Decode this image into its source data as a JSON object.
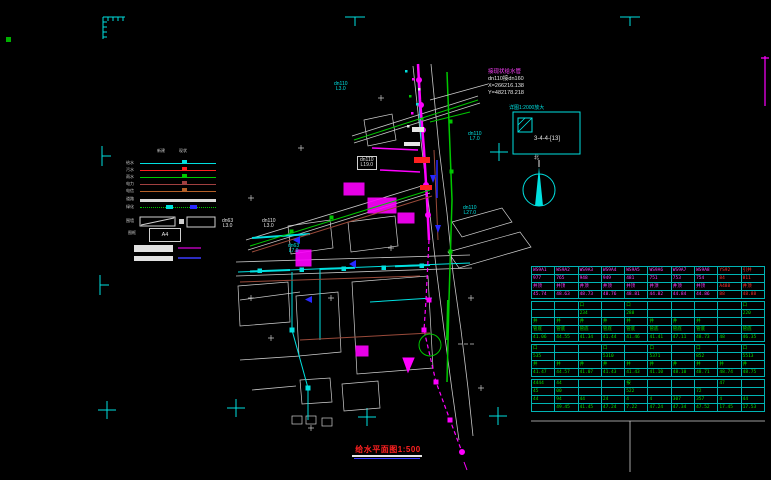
{
  "colors": {
    "cyan": "#00e0e0",
    "magenta": "#ff00ff",
    "green": "#00c800",
    "white": "#d8d8d8",
    "red": "#ff3030",
    "blue": "#2828ff",
    "brown": "#9a4a3a"
  },
  "annotation": {
    "line1": "接现状给水管",
    "line2": "dn110接dn160",
    "line3": "X=266216.138",
    "line4": "Y=482178.218"
  },
  "detail": {
    "caption": "详图1:2000放大",
    "ref": "3-4-4-[13]"
  },
  "north": {
    "label": "北"
  },
  "title": {
    "text": "给水平面图1:500"
  },
  "legend": {
    "col_headers": [
      "新建",
      "现状"
    ],
    "rows": [
      {
        "label": "给水",
        "color": "#00e0e0",
        "style": "solid"
      },
      {
        "label": "污水",
        "color": "#ff2020",
        "style": "solid"
      },
      {
        "label": "雨水",
        "color": "#00c800",
        "style": "solid"
      },
      {
        "label": "电力",
        "color": "#a04040",
        "style": "solid"
      },
      {
        "label": "电信",
        "color": "#b46028",
        "style": "solid"
      },
      {
        "label": "道路",
        "color": "#d8d8d8",
        "style": "thick"
      },
      {
        "label": "绿化",
        "color": "#00c800",
        "style": "dotted"
      }
    ],
    "slope_label": "围墙",
    "frame_label": "图框",
    "frame_text": "A4"
  },
  "drawing": {
    "labels": [
      {
        "lines": [
          "dn110",
          "L3.0"
        ],
        "x": 334,
        "y": 82,
        "color": "#00e0e0",
        "boxed": false
      },
      {
        "lines": [
          "dn110",
          "L19.0"
        ],
        "x": 357,
        "y": 156,
        "color": "#e6e6e6",
        "boxed": true
      },
      {
        "lines": [
          "dn63",
          "L3.0"
        ],
        "x": 222,
        "y": 219,
        "color": "#e6e6e6",
        "boxed": false
      },
      {
        "lines": [
          "dn110",
          "L3.0"
        ],
        "x": 262,
        "y": 219,
        "color": "#e6e6e6",
        "boxed": false
      },
      {
        "lines": [
          "dn110",
          "L7.0"
        ],
        "x": 468,
        "y": 132,
        "color": "#00e0e0",
        "boxed": false
      },
      {
        "lines": [
          "dn110",
          "L27.0"
        ],
        "x": 463,
        "y": 206,
        "color": "#00e0e0",
        "boxed": false
      },
      {
        "lines": [
          "dn63",
          "L7.0"
        ],
        "x": 288,
        "y": 244,
        "color": "#00e0e0",
        "boxed": false
      }
    ]
  },
  "marks": [
    {
      "x": 108,
      "y": 22,
      "type": "corner"
    },
    {
      "x": 355,
      "y": 17,
      "type": "t-down"
    },
    {
      "x": 630,
      "y": 17,
      "type": "t-down"
    },
    {
      "x": 102,
      "y": 156,
      "type": "t-right"
    },
    {
      "x": 100,
      "y": 285,
      "type": "t-right"
    },
    {
      "x": 107,
      "y": 410,
      "type": "plus"
    },
    {
      "x": 236,
      "y": 408,
      "type": "plus"
    },
    {
      "x": 367,
      "y": 417,
      "type": "plus"
    },
    {
      "x": 498,
      "y": 416,
      "type": "plus"
    },
    {
      "x": 499,
      "y": 152,
      "type": "plus"
    }
  ],
  "table": {
    "x": 531,
    "y": 266,
    "w": 234,
    "sections": [
      {
        "color": "#ff40ff",
        "redCols": [
          8,
          9
        ],
        "rows": [
          [
            "WS9A1",
            "WS9A2",
            "WS9A3",
            "WS9A4",
            "WS9A5",
            "WS9A6",
            "WS9A7",
            "WS9A8",
            "YS92",
            "引井"
          ],
          [
            "977",
            "765",
            "948",
            "949",
            "481",
            "751",
            "753",
            "754",
            "84",
            "811"
          ],
          [
            "井顶",
            "井顶",
            "井顶",
            "井顶",
            "井顶",
            "井顶",
            "井顶",
            "井顶",
            "A488",
            "井顶"
          ],
          [
            "45.74",
            "48.63",
            "48.73",
            "48.76",
            "48.81",
            "44.82",
            "44.84",
            "44.86",
            "88",
            "48.88"
          ]
        ]
      },
      {
        "color": "#00e000",
        "rows": [
          [
            "",
            "",
            "口",
            "",
            "口",
            "",
            "",
            "",
            "",
            "口"
          ],
          [
            "",
            "",
            "234",
            "",
            "288",
            "",
            "",
            "",
            "",
            "220"
          ],
          [
            "井",
            "井",
            "井",
            "井",
            "井",
            "井",
            "井",
            "井",
            "",
            ""
          ],
          [
            "管底",
            "管底",
            "管底",
            "管底",
            "管底",
            "管底",
            "管底",
            "管底",
            "",
            "管底"
          ],
          [
            "41.06",
            "44.55",
            "41.34",
            "41.44",
            "41.46",
            "41.41",
            "47.11",
            "48.73",
            "48",
            "46.35"
          ]
        ]
      },
      {
        "color": "#00e000",
        "rows": [
          [
            "口",
            "",
            "",
            "口",
            "",
            "口",
            "",
            "口",
            "",
            "口"
          ],
          [
            "535",
            "",
            "",
            "5310",
            "",
            "5371",
            "",
            "852",
            "",
            "5513"
          ],
          [
            "井",
            "井",
            "井",
            "井",
            "井",
            "井",
            "井",
            "井",
            "井",
            "井"
          ],
          [
            "41.47",
            "44.57",
            "41.07",
            "41.43",
            "41.43",
            "41.10",
            "48.10",
            "48.71",
            "48.74",
            "48.75"
          ]
        ]
      },
      {
        "color": "#00e000",
        "rows": [
          [
            "4444",
            "44",
            "",
            "",
            "按",
            "",
            "",
            "",
            "47",
            ""
          ],
          [
            "45",
            "00",
            "",
            "",
            "522",
            "",
            "",
            "72",
            "",
            ""
          ],
          [
            "44",
            "94",
            "44",
            "24",
            "4",
            "4",
            "307",
            "357",
            "4",
            "44"
          ],
          [
            "",
            "49.45",
            "41.45",
            "47.24",
            "7.22",
            "47.24",
            "47.34",
            "47.52",
            "17.45",
            "17.53"
          ]
        ]
      }
    ]
  }
}
